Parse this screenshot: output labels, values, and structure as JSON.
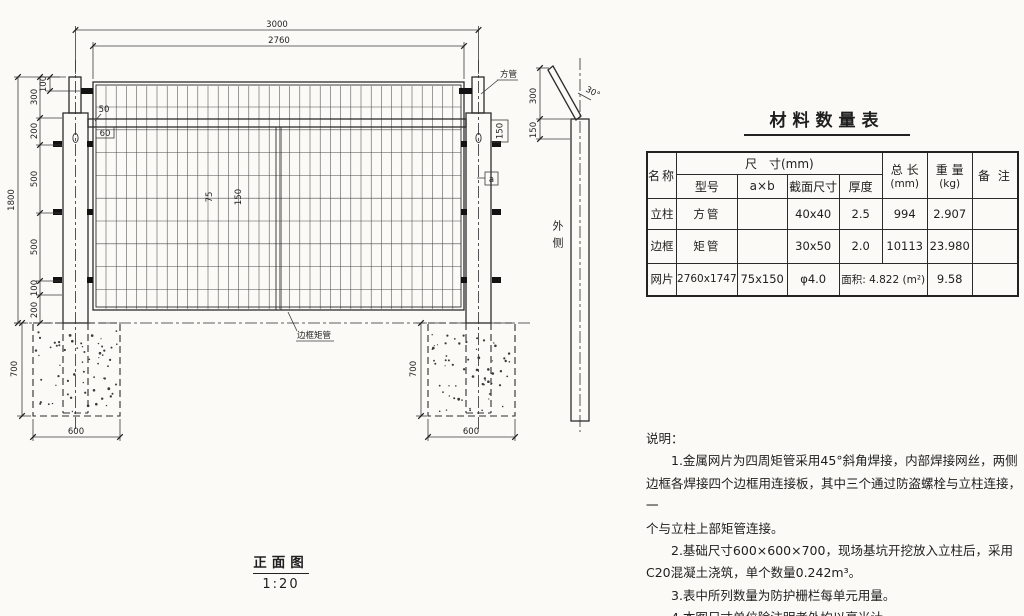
{
  "colors": {
    "paper": "#fbfaf6",
    "ink": "#2c2c2c"
  },
  "front_view": {
    "title": "正面图",
    "scale": "1:20",
    "dims": {
      "overall_width": "3000",
      "panel_width": "2760",
      "overall_height": "1800",
      "left_chain": [
        "300",
        "200",
        "500",
        "500",
        "100",
        "200"
      ],
      "top_offset": "100",
      "rail_gap_top": "50",
      "rail_gap_bottom": "60",
      "mesh_pitch_h": "75",
      "mesh_pitch_v": "150",
      "post_top_inset": "150",
      "detail_mark": "a",
      "foundation_depth_left": "700",
      "foundation_width_left": "600",
      "foundation_depth_right": "700",
      "foundation_width_right": "600"
    },
    "labels": {
      "square_tube": "方管",
      "edge_frame_tube": "边框矩管"
    }
  },
  "side_view": {
    "dims": {
      "arm_height": "300",
      "arm_angle": "30°",
      "top_inset": "150"
    },
    "outer_side": "外侧"
  },
  "material_table": {
    "title": "材料数量表",
    "headers": {
      "name": "名称",
      "size_group": "尺　寸(mm)",
      "model": "型号",
      "axb": "a×b",
      "section": "截面尺寸",
      "thickness": "厚度",
      "total_length": "总 长",
      "total_length_unit": "(mm)",
      "weight": "重 量",
      "weight_unit": "(kg)",
      "remark": "备 注"
    },
    "rows": [
      {
        "name": "立柱",
        "model": "方管",
        "axb": "",
        "section": "40x40",
        "thickness": "2.5",
        "total": "994",
        "weight": "2.907",
        "remark": ""
      },
      {
        "name": "边框",
        "model": "矩管",
        "axb": "",
        "section": "30x50",
        "thickness": "2.0",
        "total": "10113",
        "weight": "23.980",
        "remark": ""
      },
      {
        "name": "网片",
        "model": "2760x1747",
        "axb": "75x150",
        "section": "φ4.0",
        "area": "面积: 4.822 (m²)",
        "weight": "9.58",
        "remark": ""
      }
    ]
  },
  "notes": {
    "lines": [
      "说明：",
      "1.金属网片为四周矩管采用45°斜角焊接，内部焊接网丝，两侧",
      "边框各焊接四个边框用连接板，其中三个通过防盗螺栓与立柱连接，一",
      "个与立柱上部矩管连接。",
      "2.基础尺寸600×600×700，现场基坑开挖放入立柱后，采用",
      "C20混凝土浇筑，单个数量0.242m³。",
      "3.表中所列数量为防护栅栏每单元用量。",
      "4.本图尺寸单位除注明者外均以毫米计。"
    ]
  }
}
